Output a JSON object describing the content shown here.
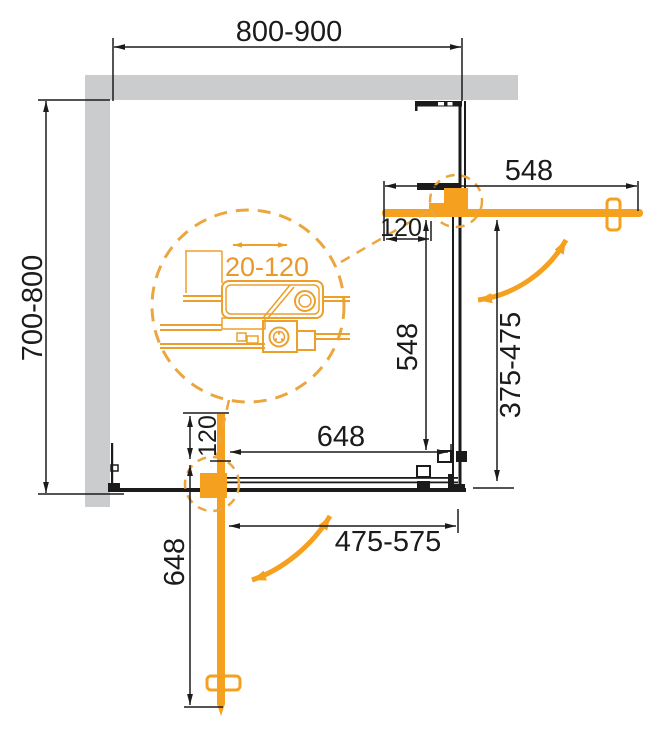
{
  "drawing": {
    "kind": "shower-enclosure-plan-view",
    "canvas": {
      "width": 661,
      "height": 732
    },
    "colors": {
      "door_orange": "#F5A01F",
      "detail_orange": "#ED9F2B",
      "dash_orange": "#EBA63F",
      "wall_gray": "#CACCCE",
      "line_black": "#1B1B1B"
    },
    "dimensions": {
      "top_width": "800-900",
      "left_depth": "700-800",
      "right_door_length": "548",
      "right_door_inset": "120",
      "right_panel_height": "548",
      "right_opening_range": "375-475",
      "bottom_panel_width": "648",
      "bottom_door_inset": "120",
      "bottom_door_length": "648",
      "bottom_opening_range": "475-575",
      "roller_adjustment_range": "20-120"
    }
  }
}
